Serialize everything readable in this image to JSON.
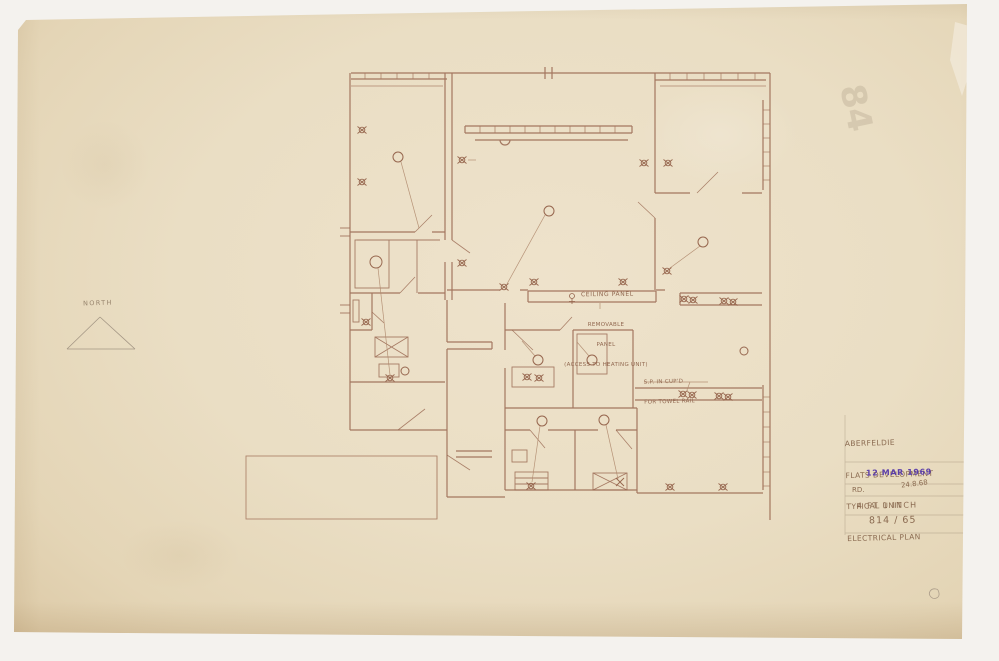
{
  "colors": {
    "paper": "#e9dcc2",
    "background": "#f4f2ee",
    "ink_sepia": "#9a6952",
    "pencil_gray": "#9c8f7e",
    "stamp_purple": "#5b3ea9"
  },
  "north_arrow": {
    "label": "NORTH"
  },
  "plan": {
    "annotations": {
      "ceiling_panel": "CEILING PANEL",
      "removable_line1": "REMOVABLE",
      "removable_line2": "PANEL",
      "removable_line3": "(ACCESS TO HEATING UNIT)",
      "towel_line1": "S.P. IN CUP'D",
      "towel_line2": "FOR TOWEL RAIL"
    }
  },
  "title_block": {
    "project_line1": "ABERFELDIE",
    "project_line2": "FLATS DEVELOPMENT",
    "project_line3": "TYPICAL UNIT",
    "project_line4": "ELECTRICAL PLAN",
    "date_stamp": "12 MAR 1969",
    "received_note": "RD.",
    "date_note": "24.8.68",
    "scale": "4 FT 1 INCH",
    "drawing_number": "814 / 65"
  },
  "margin_marks": {
    "faint_number": "84"
  }
}
